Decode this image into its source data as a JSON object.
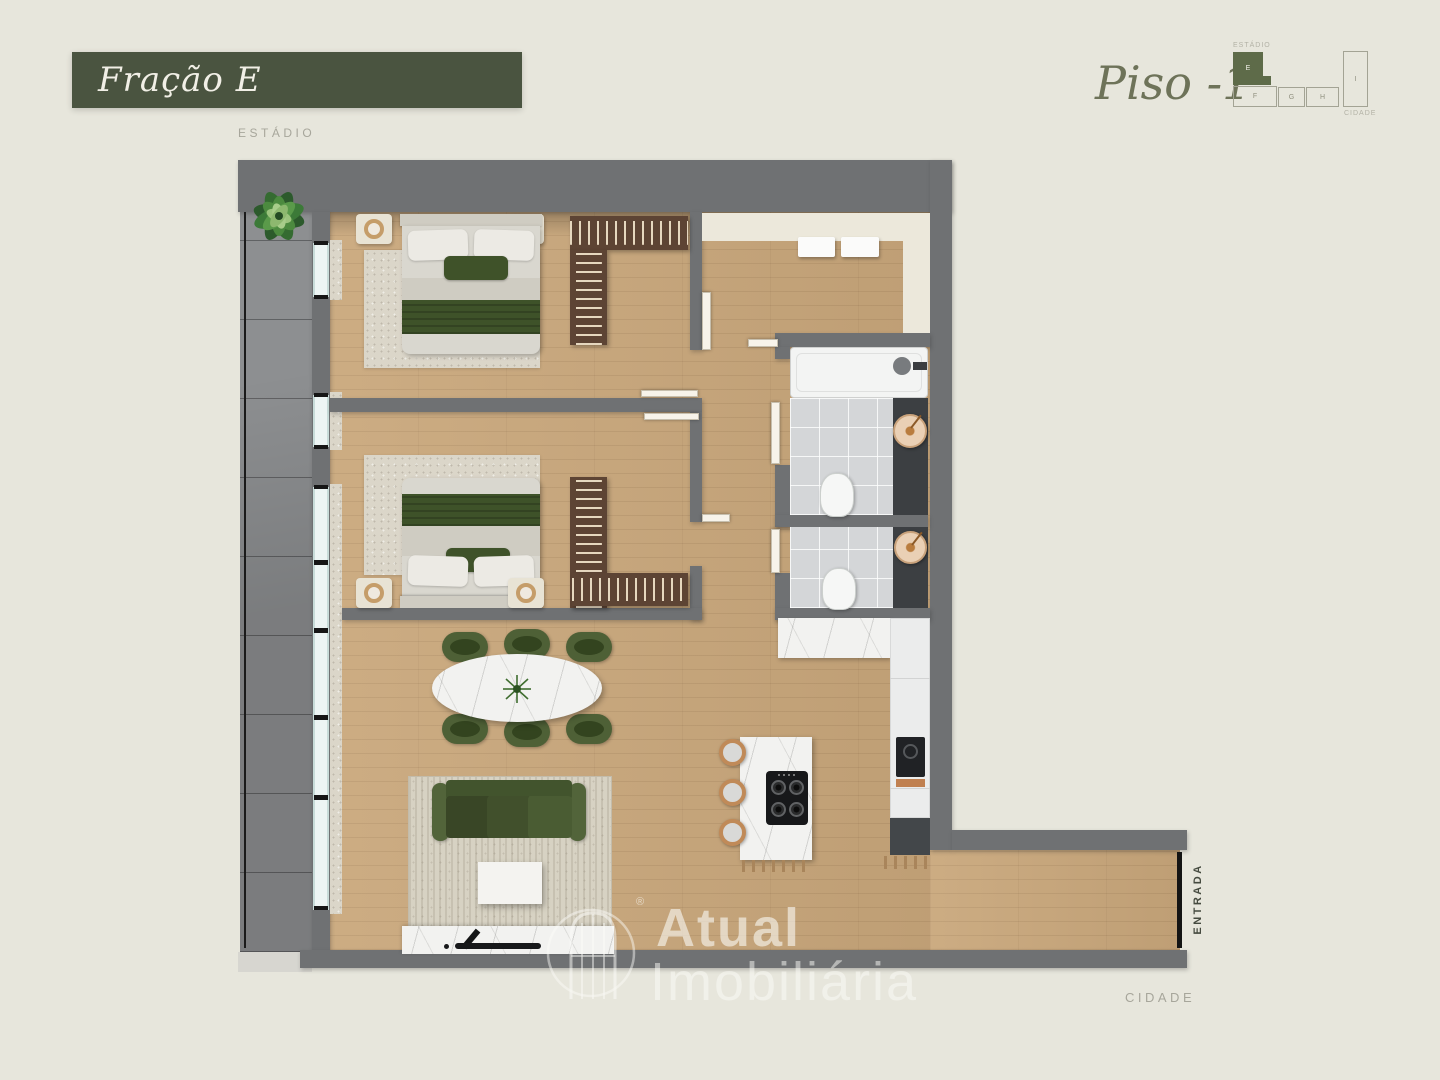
{
  "colors": {
    "background": "#e7e6dc",
    "title_bar": "#4a5440",
    "title_text": "#f1efe6",
    "floor_text": "#6e7359",
    "label_gray": "#a7a69b",
    "active_unit_green": "#5e6b49",
    "wall_gray": "#6f7173",
    "wood_floor": "#c9a77b",
    "entrance_text": "#454a3f"
  },
  "header": {
    "fraction_title": "Fração E",
    "floor_label": "Piso -1",
    "context_label": "ESTÁDIO"
  },
  "minimap": {
    "top_label": "ESTÁDIO",
    "bottom_label": "CIDADE",
    "units": [
      {
        "label": "E",
        "active": true
      },
      {
        "label": "F",
        "active": false
      },
      {
        "label": "G",
        "active": false
      },
      {
        "label": "H",
        "active": false
      },
      {
        "label": "I",
        "active": false
      }
    ]
  },
  "plan": {
    "entrance_label": "ENTRADA",
    "bottom_context_label": "CIDADE"
  },
  "watermark": {
    "brand_top": "Atual",
    "brand_bottom": "Imobiliária",
    "registered": "®"
  }
}
